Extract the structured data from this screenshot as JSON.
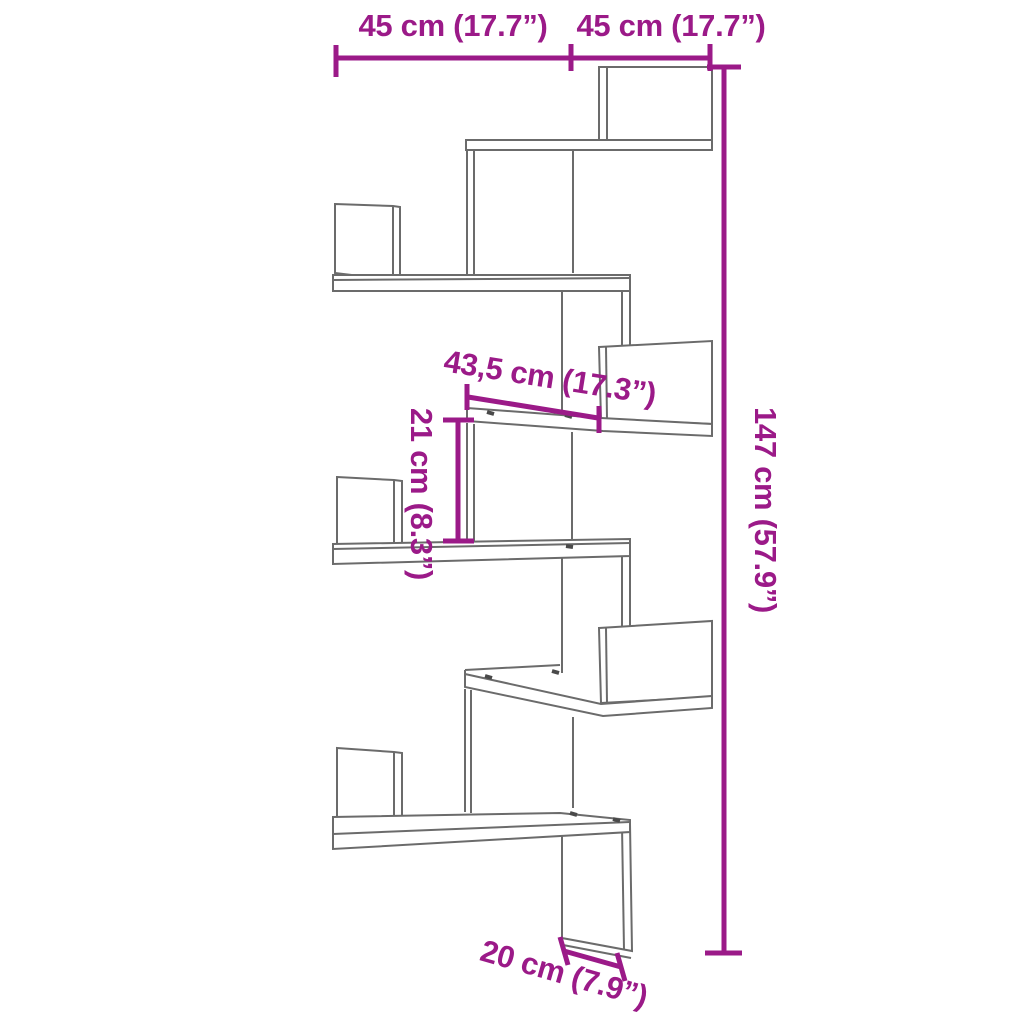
{
  "diagram": {
    "labels": {
      "top_left_width": "45 cm (17.7”)",
      "top_right_width": "45 cm (17.7”)",
      "total_height": "147 cm (57.9”)",
      "shelf_width": "43,5 cm (17.3”)",
      "shelf_spacing": "21 cm (8.3”)",
      "bottom_depth": "20 cm (7.9”)"
    },
    "colors": {
      "dimension_accent": "#9b1a88",
      "drawing_outline": "#6b6b6b",
      "background": "#ffffff"
    }
  }
}
